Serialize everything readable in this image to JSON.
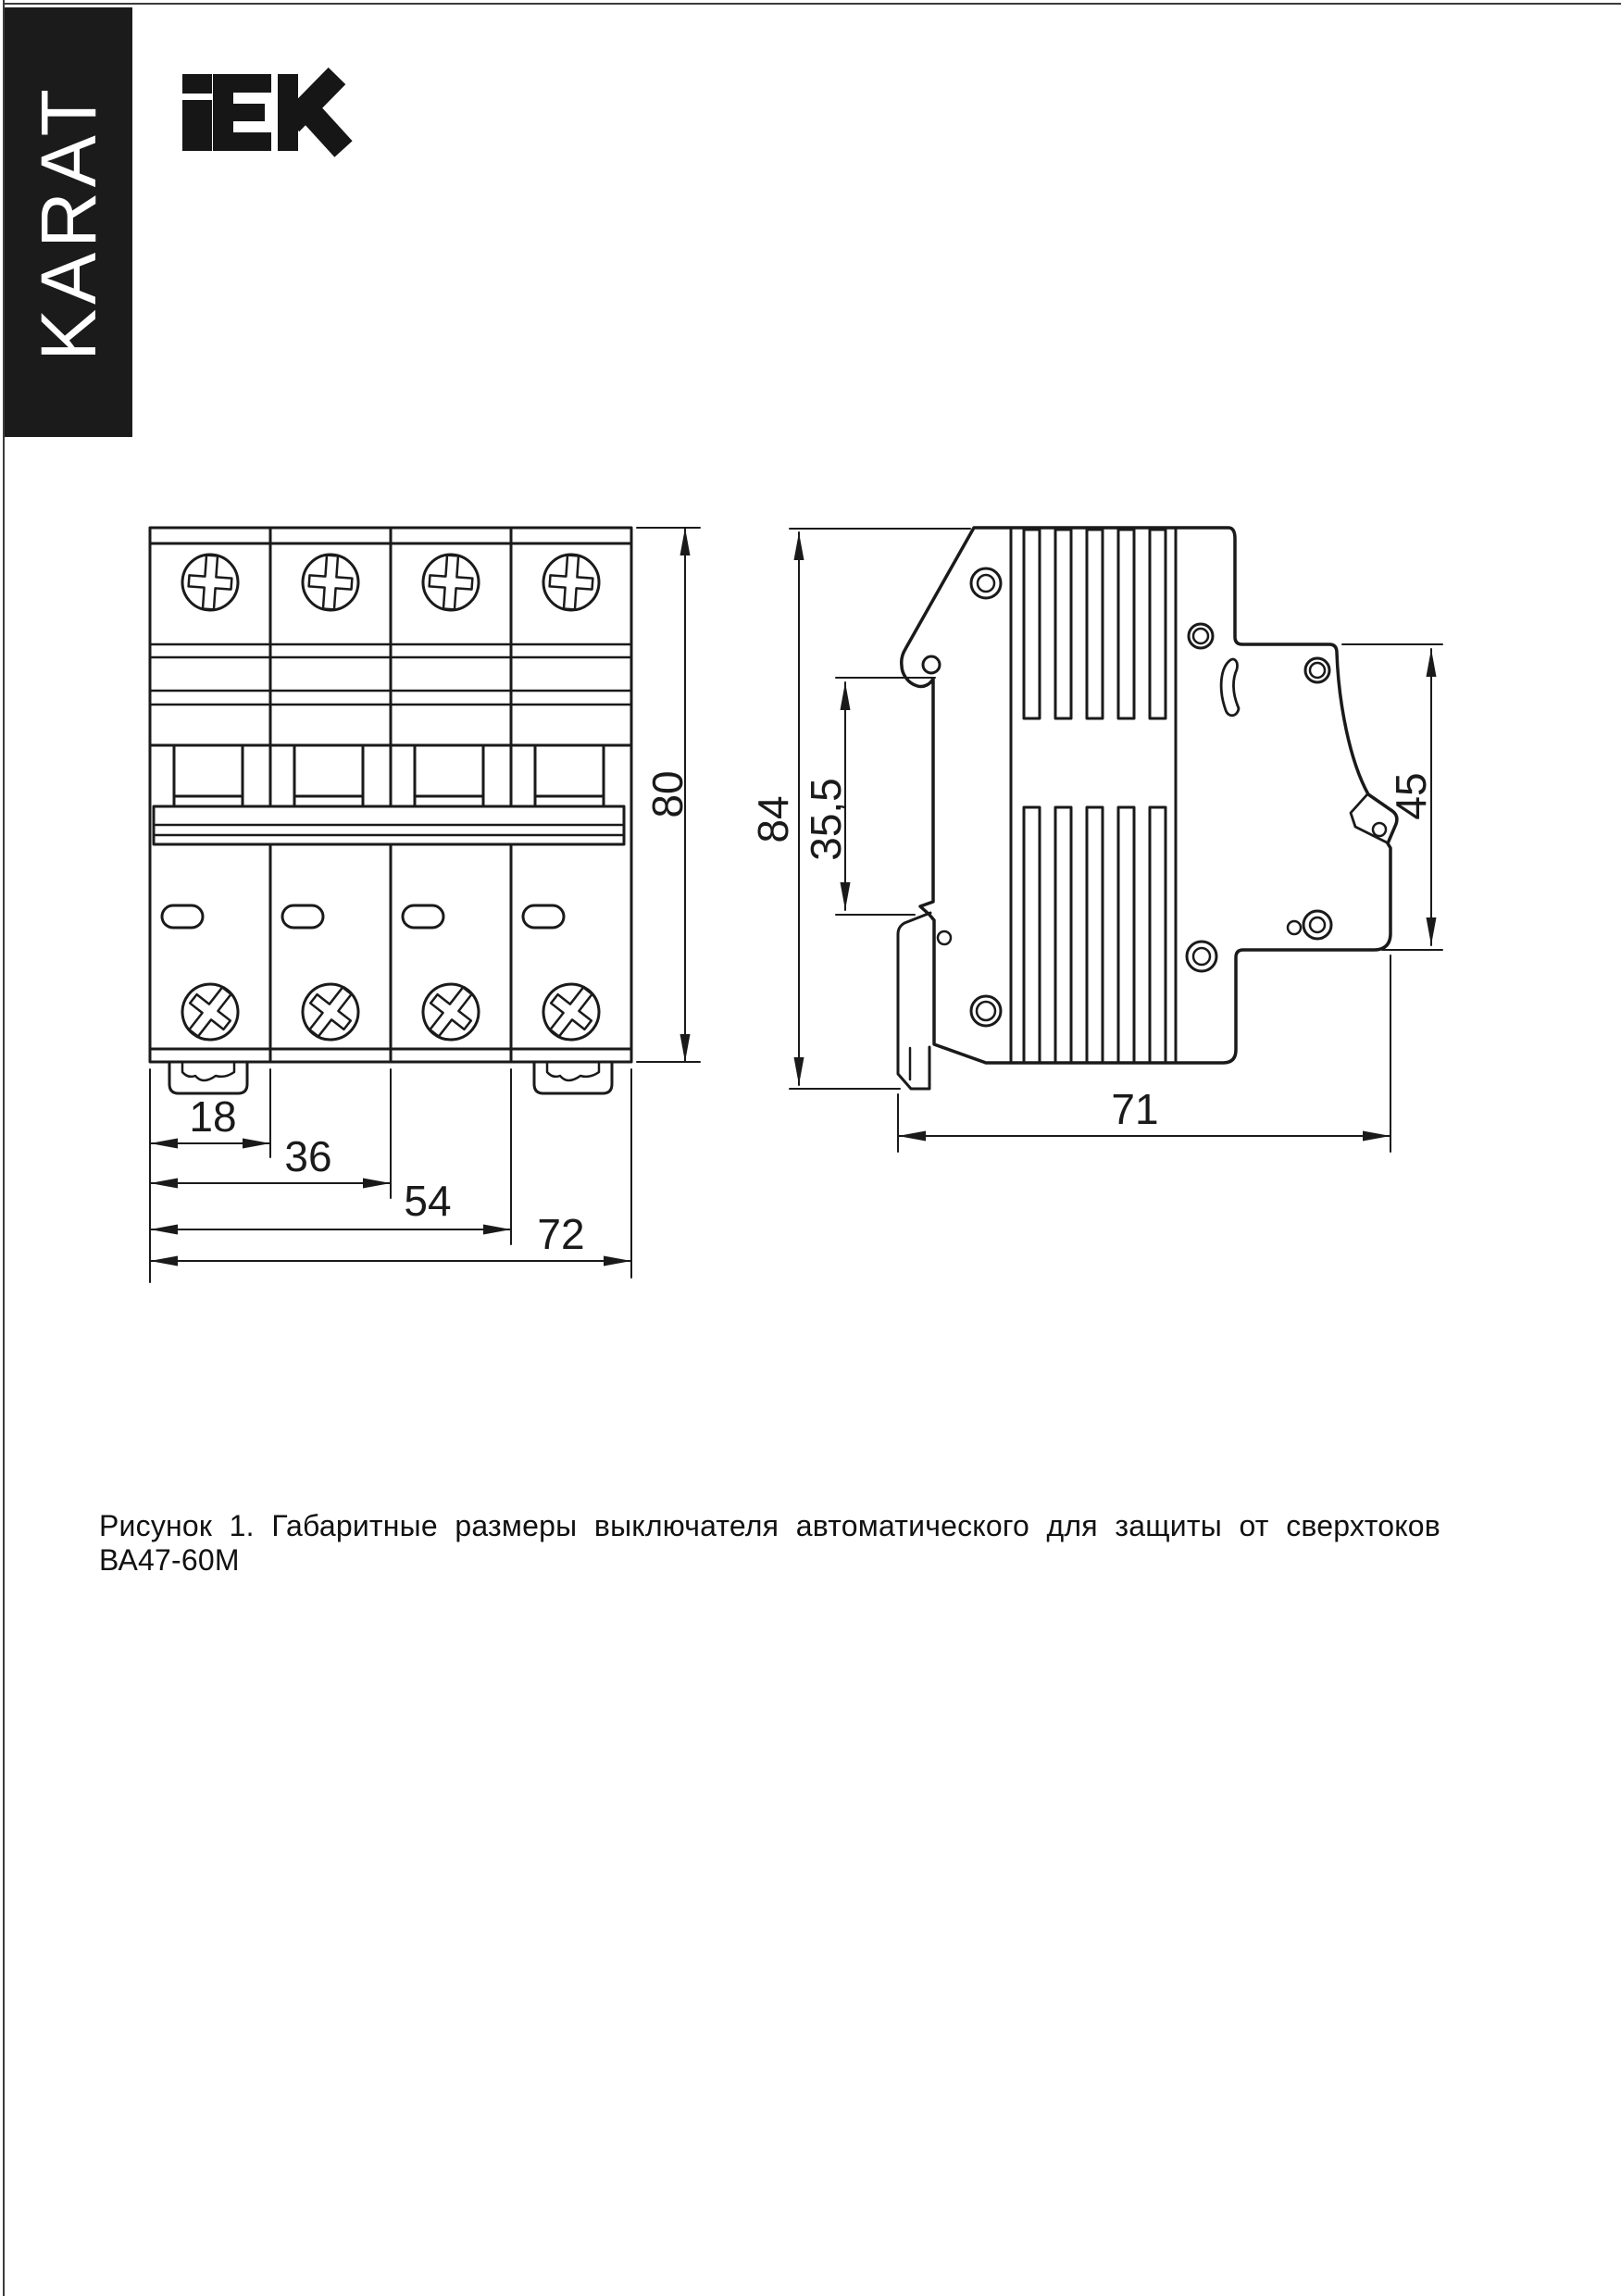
{
  "page": {
    "bg": "#ffffff",
    "stroke": "#1a1a1a",
    "border": "#3c3c3c"
  },
  "branding": {
    "karat_label": "KARAT",
    "karat_bg": "#1b1b1b",
    "iek_logo_icon": "iek-logo",
    "iek_brand": "IEK"
  },
  "figure": {
    "caption": "Рисунок 1. Габаритные размеры выключателя автоматического для защиты от сверхтоков ВА47-60М",
    "front_view": {
      "dim_module_width": "18",
      "dim_two_modules": "36",
      "dim_three_modules": "54",
      "dim_total_width": "72",
      "dim_height": "80"
    },
    "side_view": {
      "dim_total_height": "84",
      "dim_rail_offset": "35,5",
      "dim_front_height": "45",
      "dim_depth": "71"
    }
  }
}
